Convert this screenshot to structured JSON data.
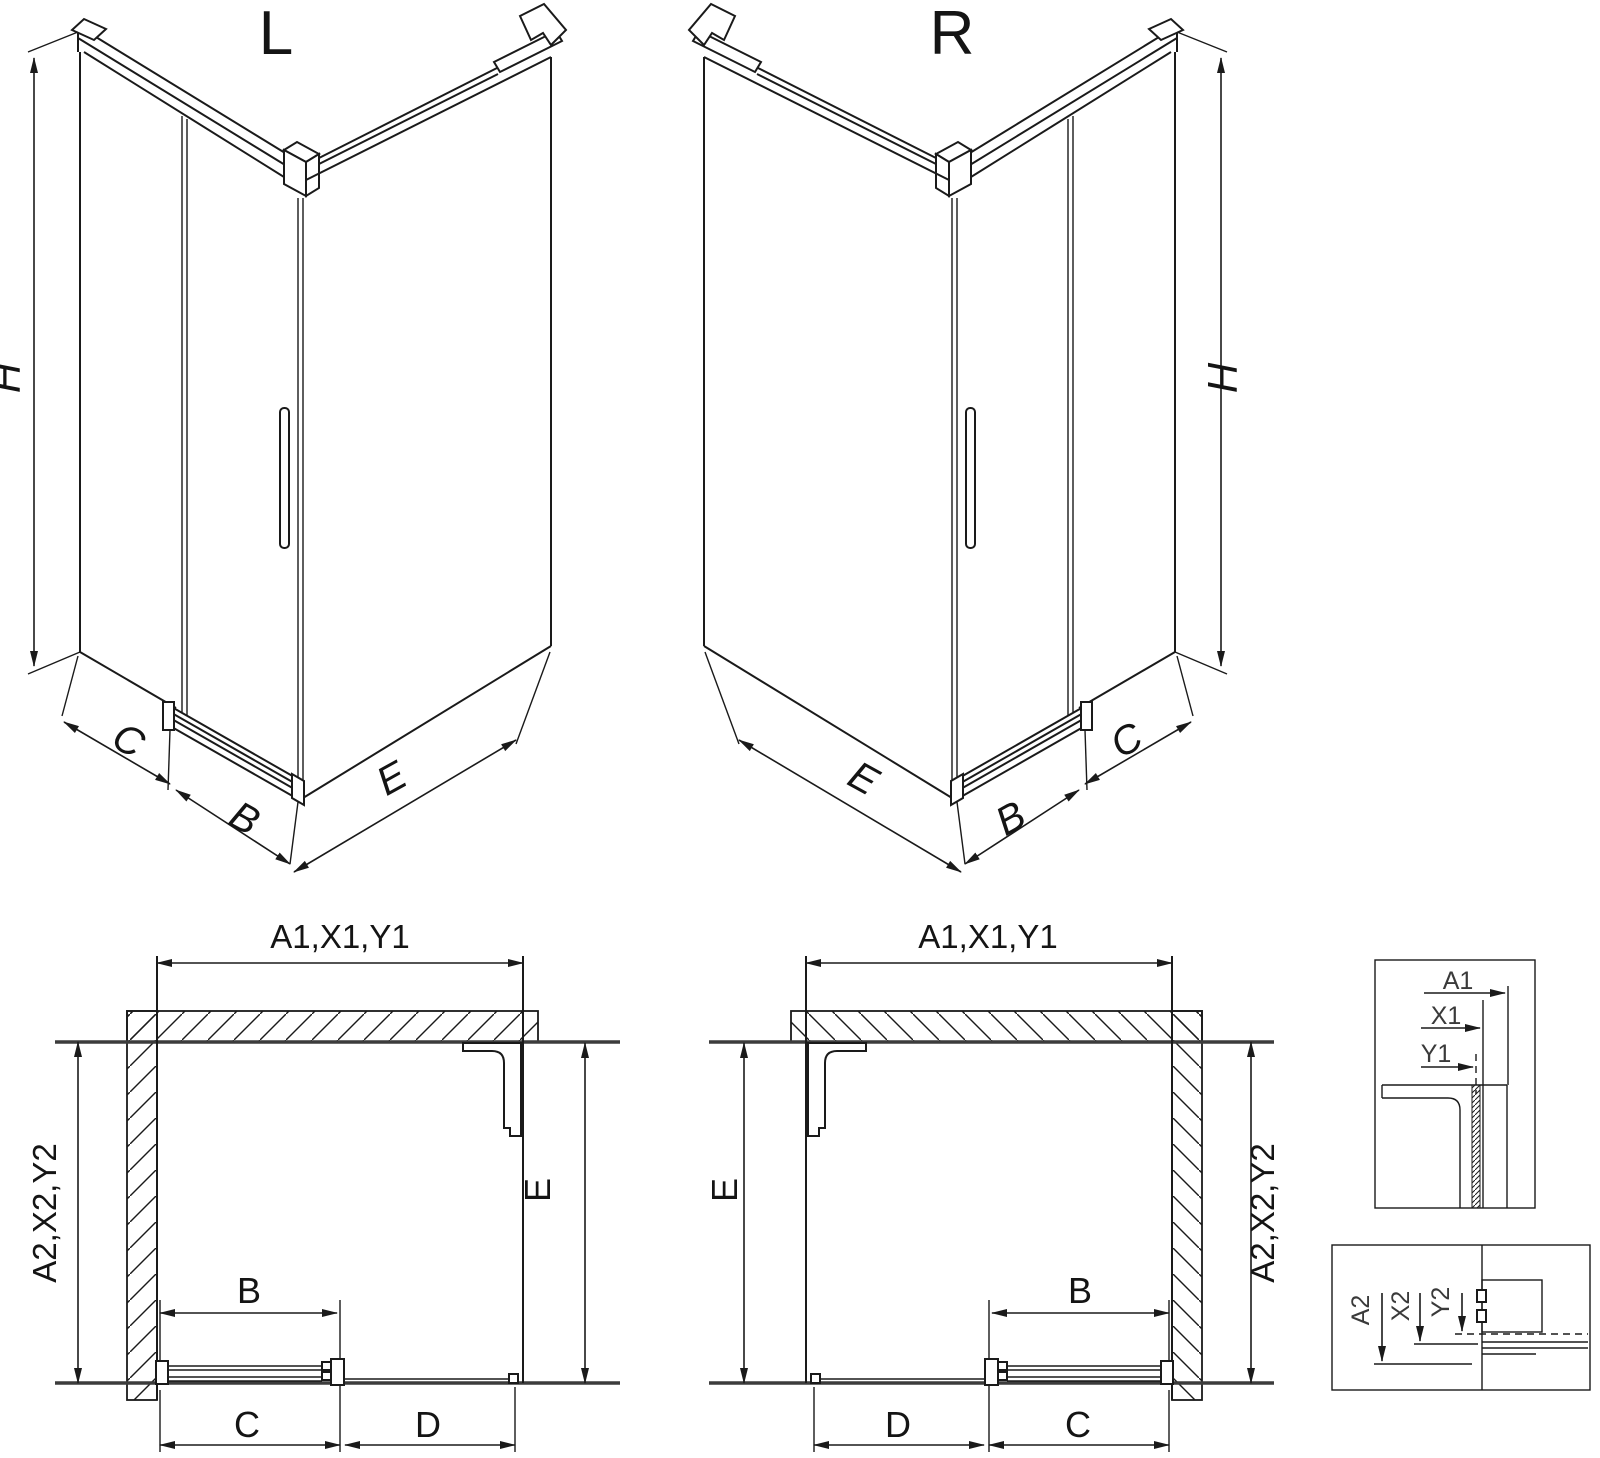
{
  "colors": {
    "background": "#ffffff",
    "line": "#1a1a1a",
    "wall_line": "#3c3c3c"
  },
  "figures": {
    "iso_left": {
      "title": "L",
      "dim_height": "H",
      "dim_side": "C",
      "dim_door": "B",
      "dim_return": "E"
    },
    "iso_right": {
      "title": "R",
      "dim_height": "H",
      "dim_side": "C",
      "dim_door": "B",
      "dim_return": "E"
    },
    "plan_left": {
      "dim_top": "A1,X1,Y1",
      "dim_left": "A2,X2,Y2",
      "dim_right": "E",
      "dim_door": "B",
      "dim_bottom_left": "C",
      "dim_bottom_right": "D"
    },
    "plan_right": {
      "dim_top": "A1,X1,Y1",
      "dim_right": "A2,X2,Y2",
      "dim_left": "E",
      "dim_door": "B",
      "dim_bottom_left": "D",
      "dim_bottom_right": "C"
    },
    "detail_top": {
      "dim_a1": "A1",
      "dim_x1": "X1",
      "dim_y1": "Y1"
    },
    "detail_bottom": {
      "dim_a2": "A2",
      "dim_x2": "X2",
      "dim_y2": "Y2"
    }
  }
}
